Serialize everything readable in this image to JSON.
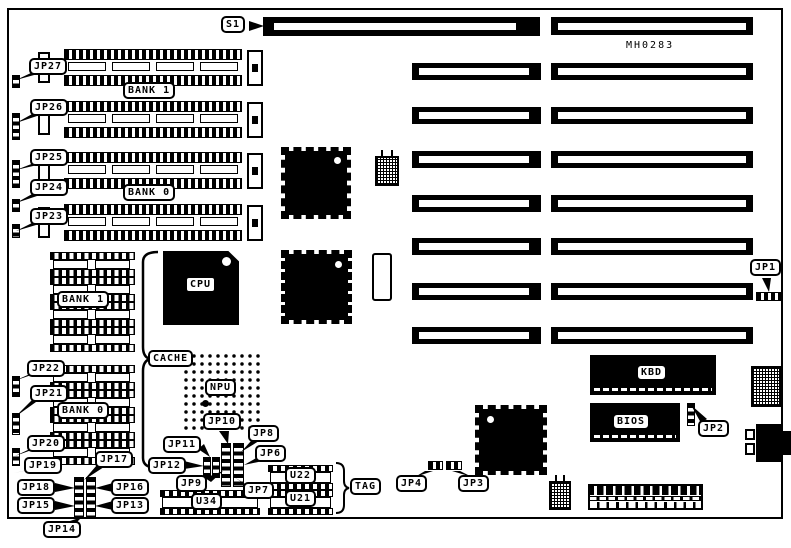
{
  "board": {
    "silkscreen_id": "MH0283"
  },
  "slots": {
    "s1": "S1"
  },
  "memory": {
    "bank1": "BANK 1",
    "bank0": "BANK 0"
  },
  "cache": {
    "label": "CACHE",
    "bank1": "BANK 1",
    "bank0": "BANK 0",
    "tag": "TAG"
  },
  "chips": {
    "cpu": "CPU",
    "npu": "NPU",
    "kbd": "KBD",
    "bios": "BIOS",
    "u22": "U22",
    "u21": "U21",
    "u34": "U34"
  },
  "jumpers": {
    "jp1": "JP1",
    "jp2": "JP2",
    "jp3": "JP3",
    "jp4": "JP4",
    "jp6": "JP6",
    "jp7": "JP7",
    "jp8": "JP8",
    "jp9": "JP9",
    "jp10": "JP10",
    "jp11": "JP11",
    "jp12": "JP12",
    "jp13": "JP13",
    "jp14": "JP14",
    "jp15": "JP15",
    "jp16": "JP16",
    "jp17": "JP17",
    "jp18": "JP18",
    "jp19": "JP19",
    "jp20": "JP20",
    "jp21": "JP21",
    "jp22": "JP22",
    "jp23": "JP23",
    "jp24": "JP24",
    "jp25": "JP25",
    "jp26": "JP26",
    "jp27": "JP27"
  },
  "colors": {
    "ink": "#000000",
    "paper": "#ffffff"
  }
}
